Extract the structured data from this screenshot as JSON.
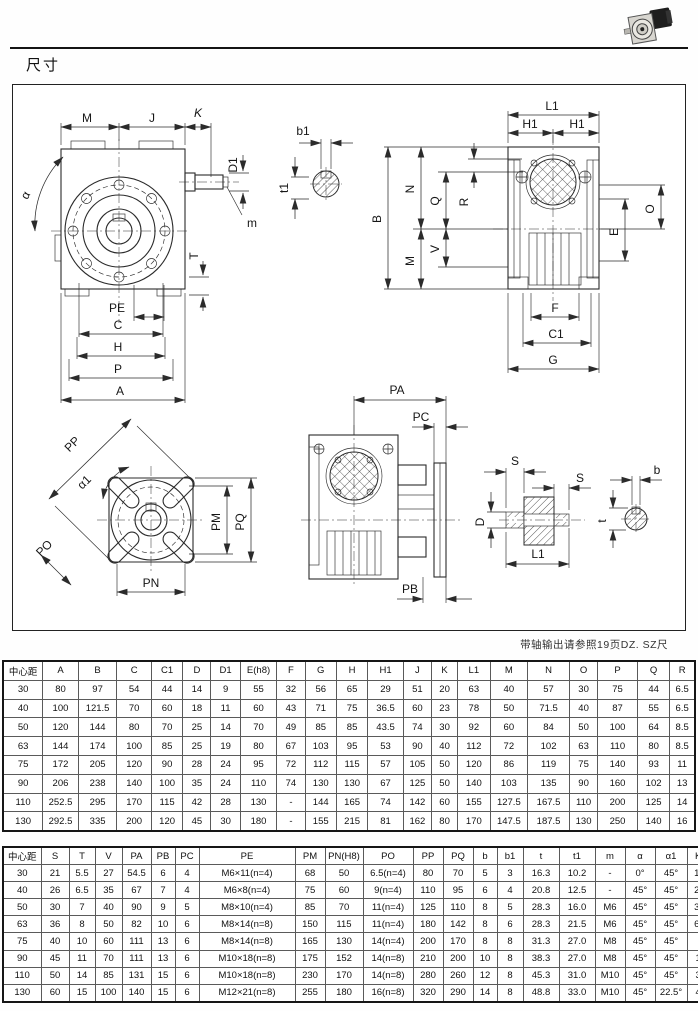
{
  "page": {
    "heading": "尺寸",
    "note": "带轴输出请参照19页DZ. SZ尺"
  },
  "colors": {
    "ink": "#1a1a1a",
    "paper": "#ffffff"
  },
  "drawing_labels": {
    "A": "A",
    "B": "B",
    "C": "C",
    "C1": "C1",
    "D": "D",
    "D1": "D1",
    "E": "E",
    "F": "F",
    "G": "G",
    "H": "H",
    "H1": "H1",
    "J": "J",
    "K": "K",
    "L1": "L1",
    "M": "M",
    "N": "N",
    "O": "O",
    "P": "P",
    "Q": "Q",
    "R": "R",
    "T": "T",
    "V": "V",
    "S": "S",
    "PA": "PA",
    "PB": "PB",
    "PC": "PC",
    "PE": "PE",
    "PM": "PM",
    "PN": "PN",
    "PO": "PO",
    "PP": "PP",
    "PQ": "PQ",
    "alpha": "α",
    "alpha1": "α1",
    "b": "b",
    "b1": "b1",
    "t": "t",
    "t1": "t1",
    "m": "m"
  },
  "table1": {
    "headers": [
      "中心距",
      "A",
      "B",
      "C",
      "C1",
      "D",
      "D1",
      "E(h8)",
      "F",
      "G",
      "H",
      "H1",
      "J",
      "K",
      "L1",
      "M",
      "N",
      "O",
      "P",
      "Q",
      "R"
    ],
    "rows": [
      [
        "30",
        "80",
        "97",
        "54",
        "44",
        "14",
        "9",
        "55",
        "32",
        "56",
        "65",
        "29",
        "51",
        "20",
        "63",
        "40",
        "57",
        "30",
        "75",
        "44",
        "6.5"
      ],
      [
        "40",
        "100",
        "121.5",
        "70",
        "60",
        "18",
        "11",
        "60",
        "43",
        "71",
        "75",
        "36.5",
        "60",
        "23",
        "78",
        "50",
        "71.5",
        "40",
        "87",
        "55",
        "6.5"
      ],
      [
        "50",
        "120",
        "144",
        "80",
        "70",
        "25",
        "14",
        "70",
        "49",
        "85",
        "85",
        "43.5",
        "74",
        "30",
        "92",
        "60",
        "84",
        "50",
        "100",
        "64",
        "8.5"
      ],
      [
        "63",
        "144",
        "174",
        "100",
        "85",
        "25",
        "19",
        "80",
        "67",
        "103",
        "95",
        "53",
        "90",
        "40",
        "112",
        "72",
        "102",
        "63",
        "110",
        "80",
        "8.5"
      ],
      [
        "75",
        "172",
        "205",
        "120",
        "90",
        "28",
        "24",
        "95",
        "72",
        "112",
        "115",
        "57",
        "105",
        "50",
        "120",
        "86",
        "119",
        "75",
        "140",
        "93",
        "11"
      ],
      [
        "90",
        "206",
        "238",
        "140",
        "100",
        "35",
        "24",
        "110",
        "74",
        "130",
        "130",
        "67",
        "125",
        "50",
        "140",
        "103",
        "135",
        "90",
        "160",
        "102",
        "13"
      ],
      [
        "110",
        "252.5",
        "295",
        "170",
        "115",
        "42",
        "28",
        "130",
        "-",
        "144",
        "165",
        "74",
        "142",
        "60",
        "155",
        "127.5",
        "167.5",
        "110",
        "200",
        "125",
        "14"
      ],
      [
        "130",
        "292.5",
        "335",
        "200",
        "120",
        "45",
        "30",
        "180",
        "-",
        "155",
        "215",
        "81",
        "162",
        "80",
        "170",
        "147.5",
        "187.5",
        "130",
        "250",
        "140",
        "16"
      ]
    ]
  },
  "table2": {
    "headers": [
      "中心距",
      "S",
      "T",
      "V",
      "PA",
      "PB",
      "PC",
      "PE",
      "PM",
      "PN(H8)",
      "PO",
      "PP",
      "PQ",
      "b",
      "b1",
      "t",
      "t1",
      "m",
      "α",
      "α1",
      "Kg"
    ],
    "rows": [
      [
        "30",
        "21",
        "5.5",
        "27",
        "54.5",
        "6",
        "4",
        "M6×11(n=4)",
        "68",
        "50",
        "6.5(n=4)",
        "80",
        "70",
        "5",
        "3",
        "16.3",
        "10.2",
        "-",
        "0°",
        "45°",
        "1.2"
      ],
      [
        "40",
        "26",
        "6.5",
        "35",
        "67",
        "7",
        "4",
        "M6×8(n=4)",
        "75",
        "60",
        "9(n=4)",
        "110",
        "95",
        "6",
        "4",
        "20.8",
        "12.5",
        "-",
        "45°",
        "45°",
        "2.3"
      ],
      [
        "50",
        "30",
        "7",
        "40",
        "90",
        "9",
        "5",
        "M8×10(n=4)",
        "85",
        "70",
        "11(n=4)",
        "125",
        "110",
        "8",
        "5",
        "28.3",
        "16.0",
        "M6",
        "45°",
        "45°",
        "3.5"
      ],
      [
        "63",
        "36",
        "8",
        "50",
        "82",
        "10",
        "6",
        "M8×14(n=8)",
        "150",
        "115",
        "11(n=4)",
        "180",
        "142",
        "8",
        "6",
        "28.3",
        "21.5",
        "M6",
        "45°",
        "45°",
        "6.2"
      ],
      [
        "75",
        "40",
        "10",
        "60",
        "111",
        "13",
        "6",
        "M8×14(n=8)",
        "165",
        "130",
        "14(n=4)",
        "200",
        "170",
        "8",
        "8",
        "31.3",
        "27.0",
        "M8",
        "45°",
        "45°",
        "9"
      ],
      [
        "90",
        "45",
        "11",
        "70",
        "111",
        "13",
        "6",
        "M10×18(n=8)",
        "175",
        "152",
        "14(n=8)",
        "210",
        "200",
        "10",
        "8",
        "38.3",
        "27.0",
        "M8",
        "45°",
        "45°",
        "13"
      ],
      [
        "110",
        "50",
        "14",
        "85",
        "131",
        "15",
        "6",
        "M10×18(n=8)",
        "230",
        "170",
        "14(n=8)",
        "280",
        "260",
        "12",
        "8",
        "45.3",
        "31.0",
        "M10",
        "45°",
        "45°",
        "35"
      ],
      [
        "130",
        "60",
        "15",
        "100",
        "140",
        "15",
        "6",
        "M12×21(n=8)",
        "255",
        "180",
        "16(n=8)",
        "320",
        "290",
        "14",
        "8",
        "48.8",
        "33.0",
        "M10",
        "45°",
        "22.5°",
        "48"
      ]
    ]
  }
}
